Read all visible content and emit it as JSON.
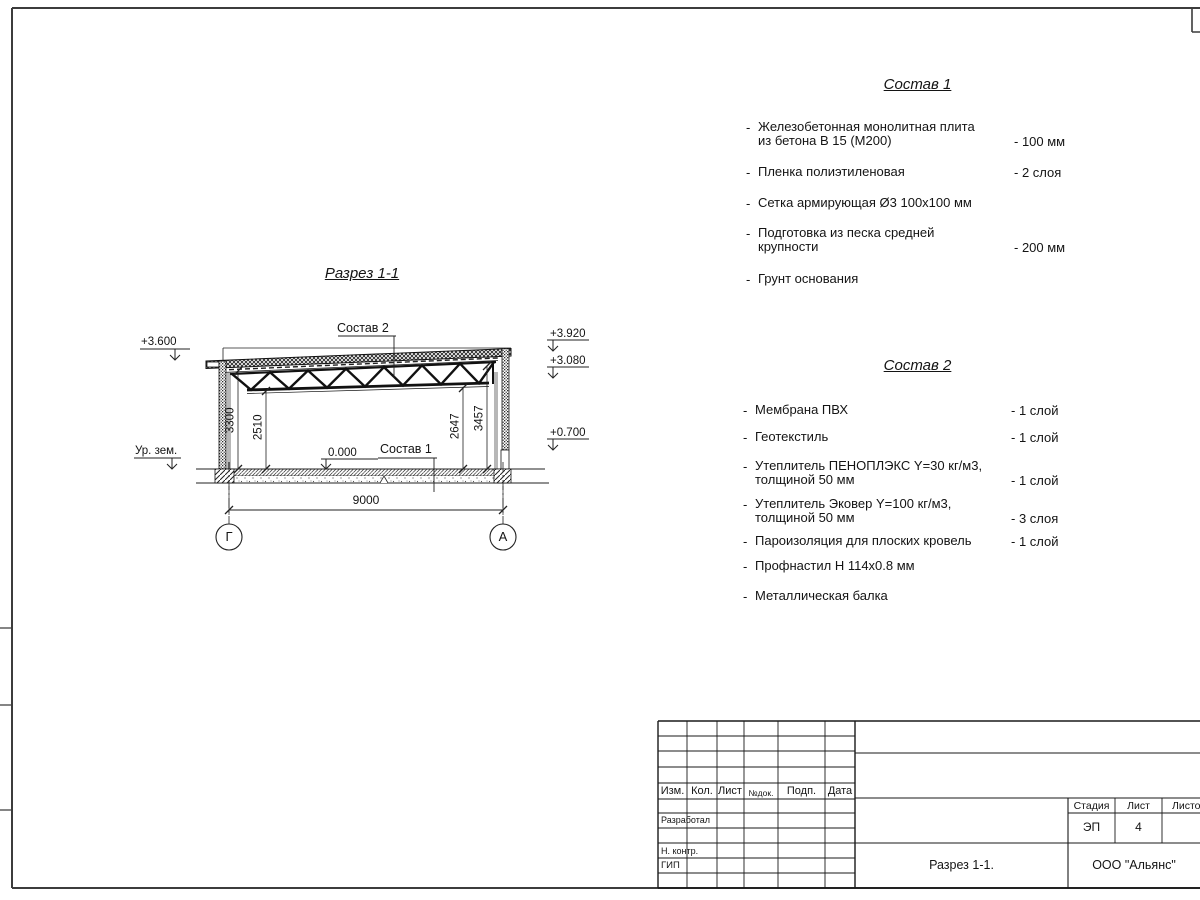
{
  "misc": {
    "dash": "-"
  },
  "drawing": {
    "title": "Разрез 1-1",
    "callout_roof": "Состав 2",
    "callout_floor": "Состав 1",
    "lev_left": "+3.600",
    "lev_r1": "+3.920",
    "lev_r2": "+3.080",
    "lev_r3": "+0.700",
    "ground": "Ур. зем.",
    "zero": "0.000",
    "dims": {
      "h1": "3300",
      "h2": "2510",
      "h3": "2647",
      "h4": "3457",
      "span": "9000"
    },
    "axes": {
      "left": "Г",
      "right": "А"
    }
  },
  "comp1": {
    "title": "Состав 1",
    "items": [
      {
        "line1": "Железобетонная  монолитная плита",
        "line2": "из бетона В 15 (М200)",
        "value": "- 100 мм"
      },
      {
        "line1": "Пленка полиэтиленовая",
        "value": "-  2 слоя"
      },
      {
        "line1": "Сетка армирующая Ø3 100х100 мм"
      },
      {
        "line1": "Подготовка из песка средней",
        "line2": "крупности",
        "value": "- 200 мм"
      },
      {
        "line1": "Грунт основания"
      }
    ]
  },
  "comp2": {
    "title": "Состав 2",
    "items": [
      {
        "line1": "Мембрана ПВХ",
        "value": "- 1 слой"
      },
      {
        "line1": "Геотекстиль",
        "value": "- 1 слой"
      },
      {
        "line1": "Утеплитель ПЕНОПЛЭКС Y=30 кг/м3,",
        "line2": "толщиной 50 мм",
        "value": "- 1 слой"
      },
      {
        "line1": "Утеплитель Эковер Y=100 кг/м3,",
        "line2": "толщиной 50 мм",
        "value": "- 3 слоя"
      },
      {
        "line1": "Пароизоляция для плоских кровель",
        "value": "- 1 слой"
      },
      {
        "line1": "Профнастил Н 114х0.8 мм"
      },
      {
        "line1": "Металлическая балка"
      }
    ]
  },
  "titleblock": {
    "cols": [
      "Изм.",
      "Кол.",
      "Лист",
      "№док.",
      "Подп.",
      "Дата"
    ],
    "rows": [
      "Разработал",
      "Н. контр.",
      "ГИП"
    ],
    "stage_label": "Стадия",
    "sheet_label": "Лист",
    "sheets_label": "Листов",
    "stage_value": "ЭП",
    "sheet_value": "4",
    "doc_title": "Разрез 1-1.",
    "company": "ООО \"Альянс\""
  }
}
